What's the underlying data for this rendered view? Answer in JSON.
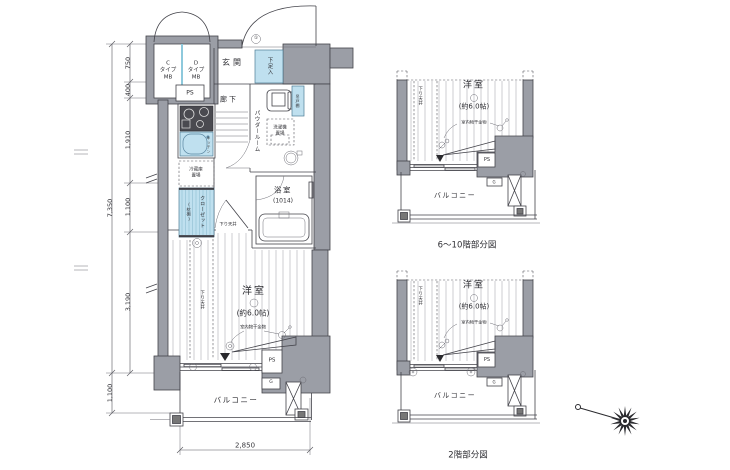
{
  "meta": {
    "drawing_type": "apartment floor plan",
    "wall_color": "#9b9ea6",
    "fixture_blue": "#bfe0ef",
    "line_color": "#43434a",
    "background": "#ffffff"
  },
  "main_plan": {
    "mb_c": {
      "l1": "C",
      "l2": "タイプ",
      "l3": "MB"
    },
    "mb_d": {
      "l1": "D",
      "l2": "タイプ",
      "l3": "MB"
    },
    "ps_top": "PS",
    "entrance": "玄関",
    "entry_mark": "①",
    "shoe_box": "下足入",
    "hallway": "廊下",
    "kitchen": "キッチン",
    "fridge_l1": "冷蔵庫",
    "fridge_l2": "置場",
    "closet": "クローゼット",
    "closet_sub": "(枕棚)",
    "powder_room": "パウダールーム",
    "cabinet": "吊戸棚",
    "washer_l1": "洗濯機",
    "washer_l2": "置場",
    "bathroom": "浴室",
    "bathroom_size": "(1014)",
    "lowered_ceiling": "下り天井",
    "room": "洋室",
    "room_size": "(約6.0帖)",
    "laundry_note": "室内物干金物",
    "ps_bottom": "PS",
    "gas": "G",
    "balcony": "バルコニー"
  },
  "dimensions": {
    "total_height": "7,350",
    "segments": [
      "750",
      "400",
      "1,910",
      "1,100",
      "3,190"
    ],
    "balcony_depth": "1,100",
    "width": "2,850"
  },
  "partial_plans": {
    "upper": {
      "room": "洋室",
      "room_size": "(約6.0帖)",
      "laundry_note": "室内物干金物",
      "lowered_ceiling": "下り天井",
      "ps": "PS",
      "gas": "G",
      "balcony": "バルコニー",
      "caption": "6〜10階部分図"
    },
    "lower": {
      "room": "洋室",
      "room_size": "(約6.0帖)",
      "laundry_note": "室内物干金物",
      "lowered_ceiling": "下り天井",
      "ps": "PS",
      "gas": "G",
      "balcony": "バルコニー",
      "caption": "2階部分図"
    }
  }
}
